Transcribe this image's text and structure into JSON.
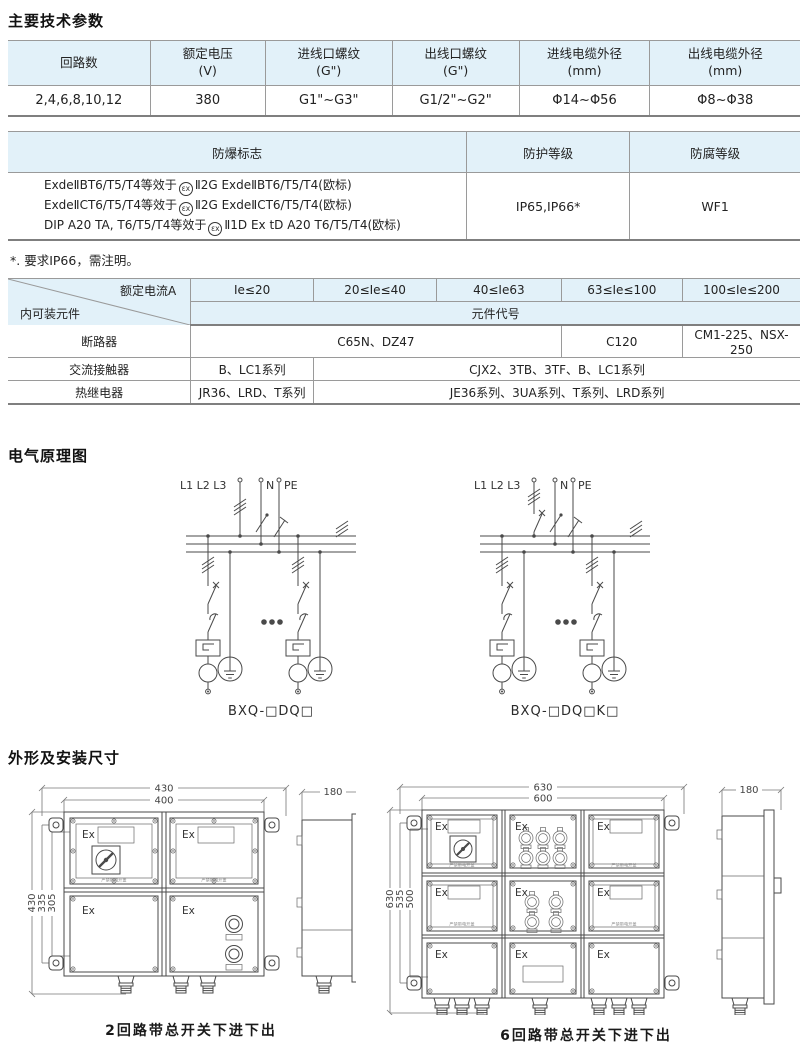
{
  "sections": {
    "params_title": "主要技术参数",
    "schematic_title": "电气原理图",
    "dimensions_title": "外形及安装尺寸"
  },
  "params_table": {
    "headers": [
      "回路数",
      "额定电压\n(V)",
      "进线口螺纹\n(G\")",
      "出线口螺纹\n(G\")",
      "进线电缆外径\n(mm)",
      "出线电缆外径\n(mm)"
    ],
    "row": [
      "2,4,6,8,10,12",
      "380",
      "G1\"~G3\"",
      "G1/2\"~G2\"",
      "Φ14~Φ56",
      "Φ8~Φ38"
    ]
  },
  "ex_table": {
    "headers": [
      "防爆标志",
      "防护等级",
      "防腐等级"
    ],
    "atex_symbol": "εx",
    "marks": [
      {
        "pre": "ExdeⅡBT6/T5/T4等效于",
        "post": "Ⅱ2G ExdeⅡBT6/T5/T4(欧标)"
      },
      {
        "pre": "ExdeⅡCT6/T5/T4等效于",
        "post": "Ⅱ2G ExdeⅡCT6/T5/T4(欧标)"
      },
      {
        "pre": "DIP A20 TA, T6/T5/T4等效于",
        "post": "Ⅱ1D Ex tD A20 T6/T5/T4(欧标)"
      }
    ],
    "protection": "IP65,IP66*",
    "corrosion": "WF1",
    "footnote": "*. 要求IP66，需注明。"
  },
  "components_table": {
    "corner_top": "额定电流A",
    "corner_bottom": "内可装元件",
    "current_headers": [
      "Ie≤20",
      "20≤Ie≤40",
      "40≤Ie63",
      "63≤Ie≤100",
      "100≤Ie≤200"
    ],
    "code_header": "元件代号",
    "rows": [
      {
        "label": "断路器",
        "c0": "C65N、DZ47",
        "c1": "C120",
        "c2": "CM1-225、NSX-250"
      },
      {
        "label": "交流接触器",
        "c0": "B、LC1系列",
        "c1": "CJX2、3TB、3TF、B、LC1系列"
      },
      {
        "label": "热继电器",
        "c0": "JR36、LRD、T系列",
        "c1": "JE36系列、3UA系列、T系列、LRD系列"
      }
    ]
  },
  "schematics": {
    "phase_label": "L1 L2 L3",
    "neutral_label": "N",
    "pe_label": "PE",
    "left_caption": "BXQ-□DQ□",
    "right_caption": "BXQ-□DQ□K□"
  },
  "drawings": {
    "left": {
      "dim_top_outer": "430",
      "dim_top_inner": "400",
      "dim_left_outer": "430",
      "dim_left_mid": "335",
      "dim_left_inner": "305",
      "dim_depth": "180",
      "ex_label": "Ex",
      "warning": "严禁带电开盖",
      "caption": "2回路带总开关下进下出"
    },
    "right": {
      "dim_top_outer": "630",
      "dim_top_inner": "600",
      "dim_left_outer": "630",
      "dim_left_mid": "535",
      "dim_left_inner": "500",
      "dim_depth": "180",
      "ex_label": "Ex",
      "warning": "严禁带电开盖",
      "caption": "6回路带总开关下进下出"
    }
  },
  "colors": {
    "header_blue": "#e2f1f9",
    "line_gray": "#9a9a9a",
    "drawing_stroke": "#4a4a4a",
    "text": "#222222"
  }
}
